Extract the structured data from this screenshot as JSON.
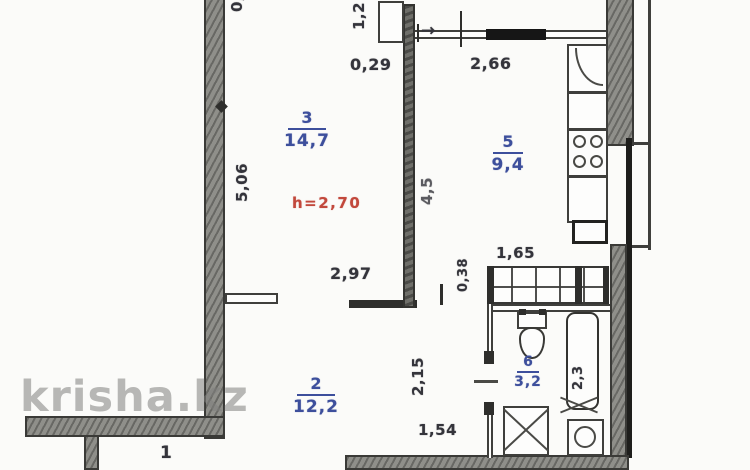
{
  "watermark": "krisha.kz",
  "colors": {
    "label_blue": "#3d4f9c",
    "dimension": "#34343b",
    "height_red": "#c2483c",
    "wall_grey": "#8f8f8a"
  },
  "plan": {
    "height_note": "h=2,70",
    "rooms": [
      {
        "id": "3",
        "number": "3",
        "area": "14,7"
      },
      {
        "id": "5",
        "number": "5",
        "area": "9,4"
      },
      {
        "id": "2",
        "number": "2",
        "area": "12,2"
      },
      {
        "id": "6",
        "number": "6",
        "area": "3,2"
      },
      {
        "id": "1",
        "number": "1",
        "area": ""
      }
    ],
    "dimensions": {
      "d029": "0,29",
      "d266": "2,66",
      "d12": "1,2",
      "d506": "5,06",
      "d45": "4,5",
      "d297": "2,97",
      "d038": "0,38",
      "d165": "1,65",
      "d215": "2,15",
      "d154": "1,54",
      "d23": "2,3",
      "partial_top": "0,"
    },
    "icons": {
      "dim_arrow": "→"
    }
  }
}
